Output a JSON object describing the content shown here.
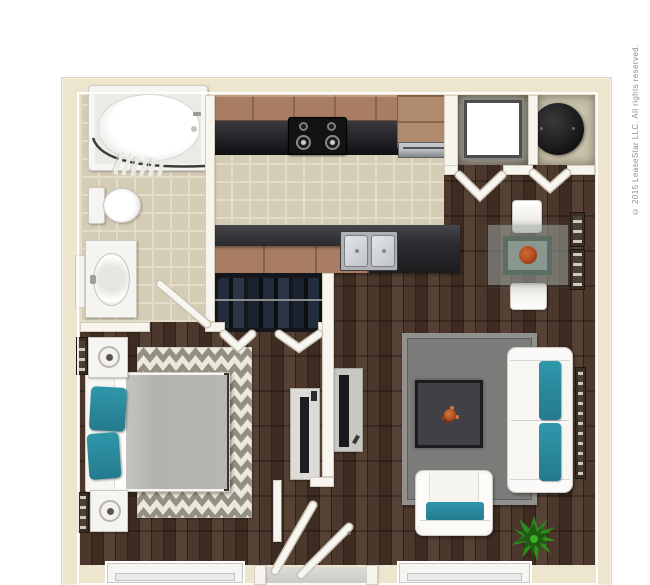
{
  "page": {
    "artwork": "3D top-down apartment floor plan render, studio/one-bedroom unit"
  },
  "copyright": {
    "text": "© 2015 LeaseStar LLC. All rights reserved."
  },
  "colors": {
    "background": "#ffffff",
    "wall_cream": "#eee5cf",
    "wall_white": "#f7f5ee",
    "wood_dark": "#3e2c23",
    "wood_mid": "#4b372c",
    "wood_light": "#564235",
    "tile_base": "#d4ccb5",
    "tile_grout": "#e3dcc8",
    "cabinet_brown": "#a87d63",
    "counter_dark": "#232327",
    "steel_gray": "#b9bdc0",
    "teal_accent": "#2f97ab",
    "rug_gray": "#7c7c7a",
    "chevron_gray": "#94907f",
    "chevron_cream": "#eceade",
    "closet_dark": "#14161b",
    "plant_green": "#2f8c1e",
    "red_centerpiece": "#b04a22",
    "glass_table": "#9aa89f",
    "window_glass": "#e8ebec",
    "text_gray": "#8f8f8a"
  },
  "rooms": {
    "bathroom": {
      "fixtures": [
        "bathtub with shower curtain",
        "toilet",
        "sink vanity",
        "wall mirror",
        "tile floor"
      ]
    },
    "kitchen": {
      "fixtures": [
        "upper cabinets",
        "black range with four burners",
        "corner cabinet",
        "stainless dishwasher",
        "peninsula counter with double stainless sink",
        "base cabinets",
        "tile floor"
      ]
    },
    "utility_closets": {
      "fixtures": [
        "white washer unit",
        "black water heater",
        "bi-fold doors"
      ]
    },
    "dining_nook": {
      "fixtures": [
        "square glass table",
        "red floral centerpiece",
        "two white chairs",
        "two wall frames"
      ]
    },
    "bedroom": {
      "fixtures": [
        "bed with gray duvet and teal pillows",
        "chevron area rug",
        "two nightstands with lamps",
        "wall art frames",
        "wardrobe closet with hanging clothes",
        "tv console"
      ]
    },
    "living_room": {
      "fixtures": [
        "white sofa with teal cushions",
        "white armchair with teal cushion",
        "gray area rug",
        "dark coffee table with centerpiece",
        "tv console",
        "green potted plant",
        "tall wall frame"
      ]
    },
    "entry": {
      "fixtures": [
        "open front door",
        "bedroom door",
        "gray threshold",
        "two windows on bottom wall"
      ]
    }
  }
}
